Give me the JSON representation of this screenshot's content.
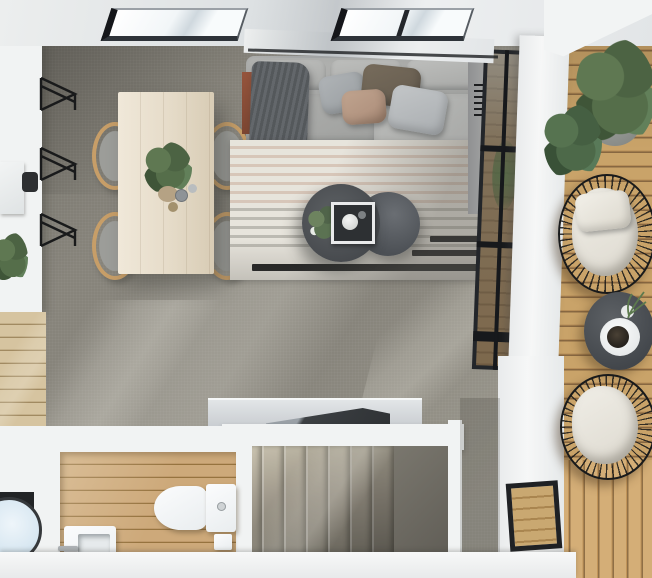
{
  "scene": {
    "title": "top-down-3d-render-of-studio-apartment",
    "areas": {
      "living_room": {
        "items": [
          "sectional-sofa",
          "back-cushions",
          "throw-pillows",
          "throw-blanket",
          "striped-area-rug",
          "round-coffee-table-large",
          "round-coffee-table-small",
          "decor-tray",
          "potted-plant",
          "terracotta-decor"
        ]
      },
      "dining_area": {
        "items": [
          "wooden-dining-table",
          "wishbone-chair",
          "wishbone-chair",
          "wishbone-chair",
          "wishbone-chair",
          "potted-plant",
          "cups"
        ]
      },
      "kitchen": {
        "items": [
          "white-island-counter",
          "cutting-board",
          "potted-plant",
          "wire-bar-stool",
          "wire-bar-stool",
          "wire-bar-stool"
        ]
      },
      "bathroom": {
        "items": [
          "toilet",
          "toilet-paper-holder",
          "washbasin",
          "faucet",
          "wood-plank-floor"
        ]
      },
      "laundry_nook": {
        "items": [
          "washing-machine"
        ]
      },
      "staircase": {
        "items": [
          "carpeted-treads",
          "balustrade",
          "handrail",
          "lower-landing"
        ]
      },
      "balcony": {
        "items": [
          "wood-decking",
          "fern-planter",
          "shrub-planter",
          "wire-lounge-chair-top",
          "wire-lounge-chair-bottom",
          "round-side-table",
          "plate-and-cup",
          "plant-sprig"
        ]
      },
      "architecture": {
        "items": [
          "skylight",
          "skylight",
          "glass-curtain-wall",
          "white-wall-column",
          "small-window",
          "wall-vent",
          "carpet-floor",
          "sunlight-streaks"
        ]
      }
    }
  },
  "palette": {
    "carpet": "#87847b",
    "carpetLight": "#9c998f",
    "carpetDark": "#6f6c65",
    "wall": "#f2f4f4",
    "ceiling": "#e7e9ea",
    "deck": "#c9a369",
    "deckDark": "#876741",
    "woodFloor": "#d6c4a0",
    "bathFloor": "#cda97a",
    "rug": "#e7e4dc",
    "sofa": "#a7a8a6",
    "throw": "#5b5f62",
    "pillowBrown": "#6b6153",
    "pillowBlush": "#b39581",
    "tableDark": "#4c5055",
    "diningWood": "#e8dfcc",
    "chairWood": "#c79e68",
    "plantGreen": "#55704a",
    "stairLight": "#cbc4b1",
    "stairDark": "#7b776c",
    "black": "#1b1c1e",
    "porcelain": "#f5f7f8",
    "laundryBlue": "#d9e8f2",
    "terracotta": "#95543c"
  }
}
